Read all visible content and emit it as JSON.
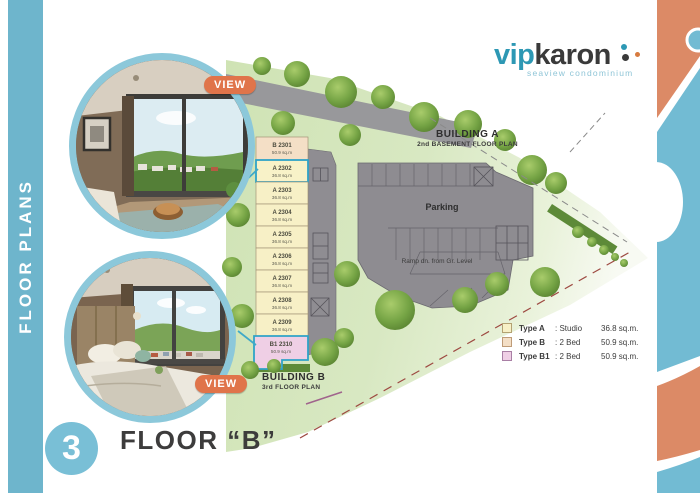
{
  "sidebar": {
    "label": "FLOOR PLANS"
  },
  "logo": {
    "vip": "vip",
    "karon": "karon",
    "tagline": "seaview condominium"
  },
  "badges": {
    "view": "VIEW"
  },
  "plan": {
    "building_a": {
      "title": "BUILDING A",
      "subtitle": "2nd BASEMENT FLOOR PLAN"
    },
    "building_b": {
      "title": "BUILDING B",
      "subtitle": "3rd FLOOR PLAN"
    },
    "parking_label": "Parking",
    "ramp_label": "Ramp dn. from Gr. Level",
    "units": [
      {
        "label": "B 2301",
        "area": "50.9 sq.m",
        "type": "B"
      },
      {
        "label": "A 2302",
        "area": "36.8 sq.m",
        "type": "A"
      },
      {
        "label": "A 2303",
        "area": "36.8 sq.m",
        "type": "A"
      },
      {
        "label": "A 2304",
        "area": "36.8 sq.m",
        "type": "A"
      },
      {
        "label": "A 2305",
        "area": "36.8 sq.m",
        "type": "A"
      },
      {
        "label": "A 2306",
        "area": "36.8 sq.m",
        "type": "A"
      },
      {
        "label": "A 2307",
        "area": "36.8 sq.m",
        "type": "A"
      },
      {
        "label": "A 2308",
        "area": "36.8 sq.m",
        "type": "A"
      },
      {
        "label": "A 2309",
        "area": "36.8 sq.m",
        "type": "A"
      },
      {
        "label": "B1 2310",
        "area": "50.9 sq.m",
        "type": "B1"
      }
    ],
    "legend": [
      {
        "name": "Type A",
        "value": ": Studio",
        "area": "36.8 sq.m."
      },
      {
        "name": "Type B",
        "value": ": 2 Bed",
        "area": "50.9 sq.m."
      },
      {
        "name": "Type B1",
        "value": ": 2 Bed",
        "area": "50.9 sq.m."
      }
    ]
  },
  "footer": {
    "number": "3",
    "title": "FLOOR “B”"
  },
  "colors": {
    "sidebar_teal": "#6eb5cc",
    "badge_orange": "#e0744a",
    "logo_teal": "#2d98b4",
    "site_green": "#d3e5bd",
    "parking_gray": "#8e8c91",
    "type_a_fill": "#f7f0c6",
    "type_b_fill": "#f4dfc6",
    "type_b1_fill": "#efcfe5",
    "highlight_teal": "#2fa3c7"
  }
}
